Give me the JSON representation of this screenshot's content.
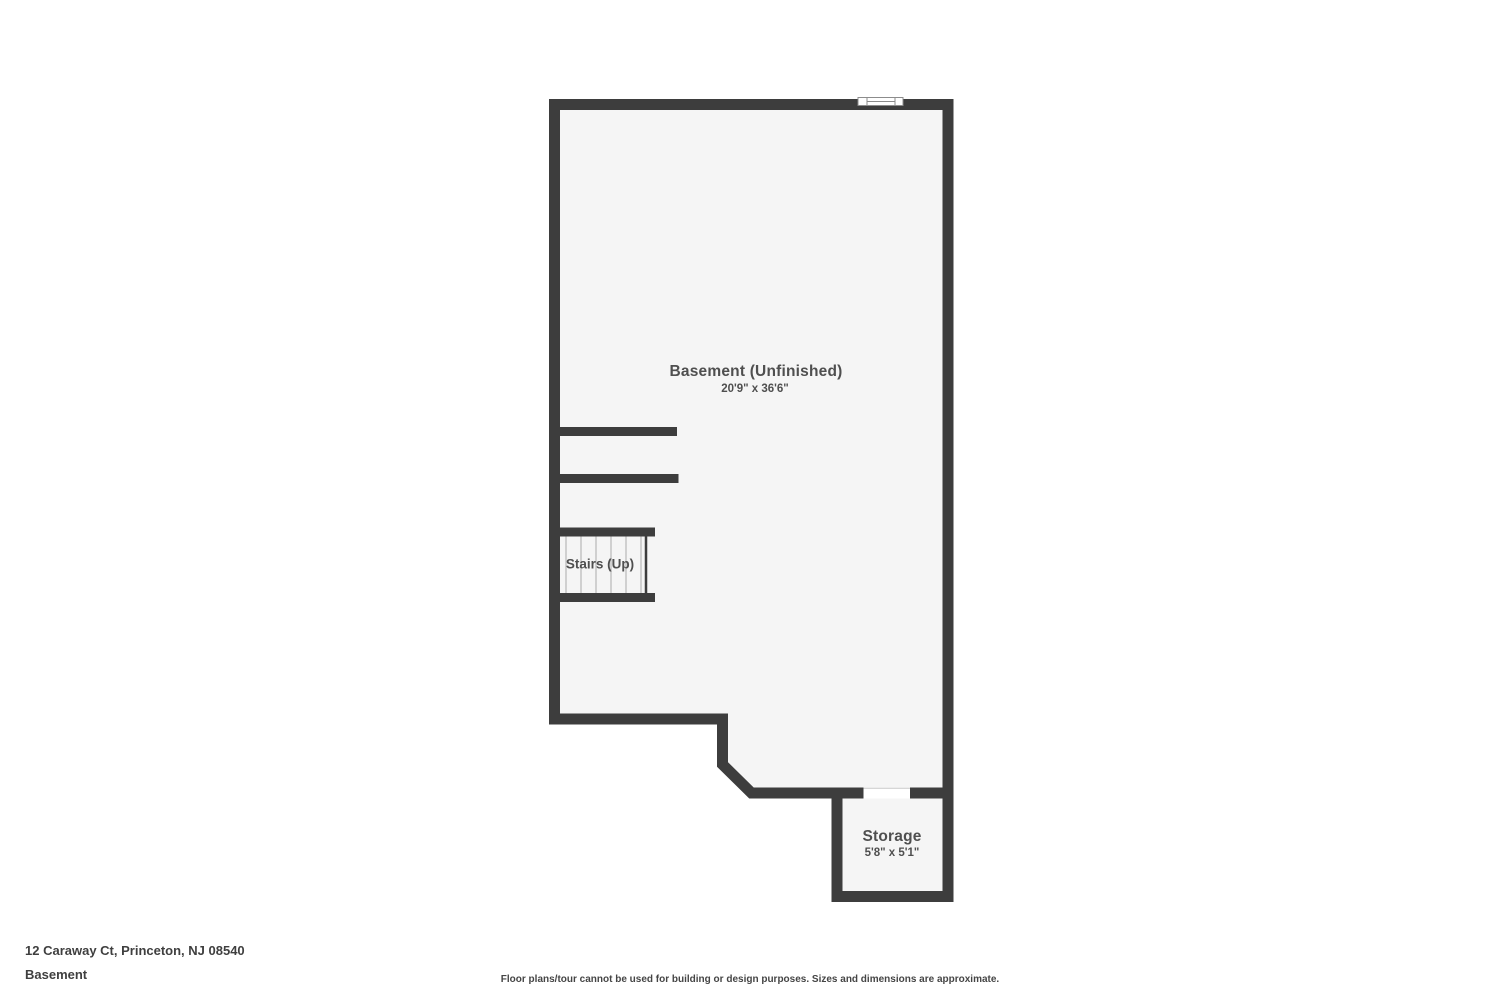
{
  "palette": {
    "background": "#ffffff",
    "floor": "#f5f5f5",
    "wall": "#3d3d3d",
    "label_text": "#4f4f4f",
    "tread_line": "#b8b8b8",
    "window_outline": "#8c8c8c",
    "door_edge": "#c9c9c9",
    "footer_text": "#3f3f3f"
  },
  "floor_plan": {
    "rooms": [
      {
        "name": "Basement (Unfinished)",
        "dimensions": "20'9\" x 36'6\""
      },
      {
        "name": "Stairs (Up)",
        "dimensions": ""
      },
      {
        "name": "Storage",
        "dimensions": "5'8\" x 5'1\""
      }
    ],
    "features": [
      {
        "type": "window",
        "location": "top-wall"
      },
      {
        "type": "door-opening",
        "location": "storage-top-wall"
      },
      {
        "type": "stair-treads",
        "count": 6
      }
    ]
  },
  "footer": {
    "address": "12 Caraway Ct, Princeton, NJ 08540",
    "floor_name": "Basement",
    "disclaimer": "Floor plans/tour cannot be used for building or design purposes. Sizes and dimensions are approximate."
  }
}
